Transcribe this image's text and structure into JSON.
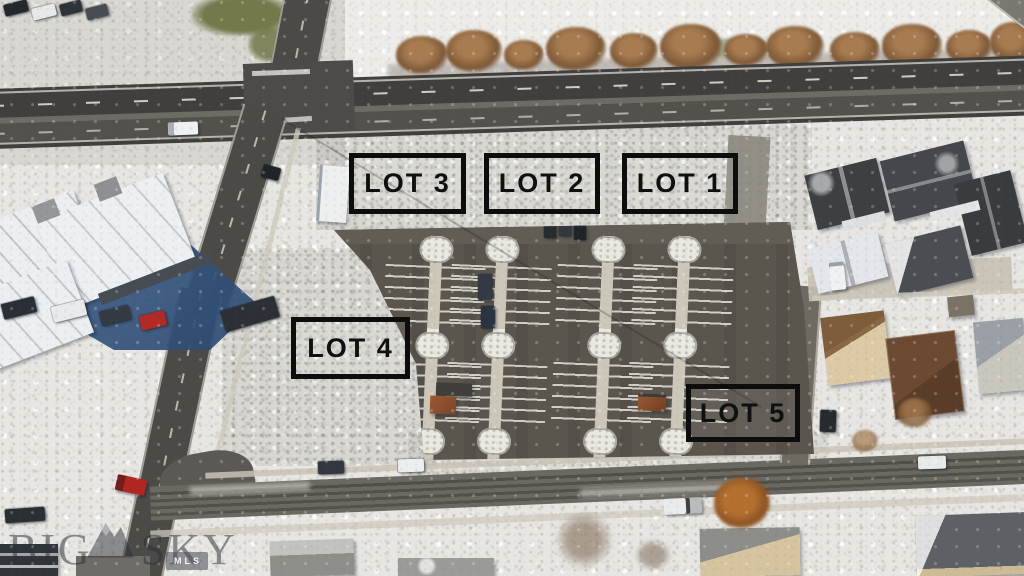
{
  "annotations": {
    "lots": [
      {
        "id": "lot-1",
        "label": "LOT 1"
      },
      {
        "id": "lot-2",
        "label": "LOT 2"
      },
      {
        "id": "lot-3",
        "label": "LOT 3"
      },
      {
        "id": "lot-4",
        "label": "LOT 4"
      },
      {
        "id": "lot-5",
        "label": "LOT 5"
      }
    ]
  },
  "watermark": {
    "brand_word_1": "BIG",
    "brand_word_2": "SKY",
    "badge": "MLS",
    "logo_icon": "mountain-icon"
  },
  "colors": {
    "label_border": "#0d0d0d",
    "label_text": "#101010",
    "snow": "#e7e6e2",
    "dirty_snow": "#d8d6cf",
    "highway_asphalt": "#413f3d",
    "street_asphalt": "#4b4a47",
    "parking_asphalt": "#5a564e",
    "concrete": "#cdc7b9",
    "building_shadow_blue": "#32517c",
    "autumn_tree": "#8f6a48",
    "grass_olive": "#74794b",
    "watermark_tint": "rgba(44,47,58,0.52)"
  }
}
